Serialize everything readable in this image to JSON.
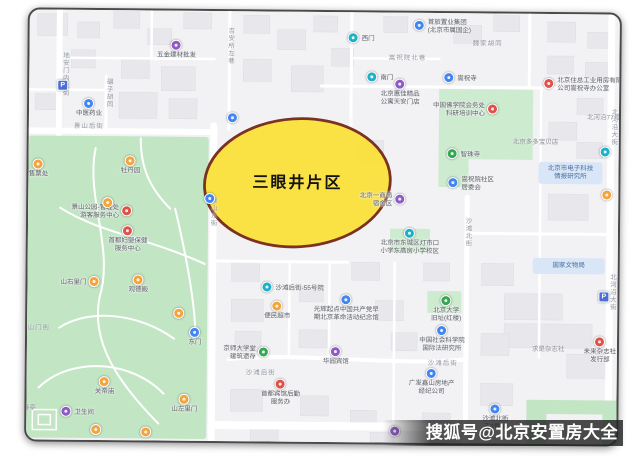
{
  "watermark": {
    "text": "搜狐号@北京安置房大全"
  },
  "highlight": {
    "label": "三眼井片区",
    "fill": "#FAE13C",
    "stroke": "#7B3222"
  },
  "map": {
    "colors": {
      "blue": "#4285F4",
      "teal": "#1FB0C9",
      "purple": "#8E5BC6",
      "orange": "#F5A33B",
      "red": "#E15149",
      "green": "#34A853",
      "parking": "#4A6FD6",
      "park_green": "#C2E5C4",
      "compound_green": "#CDEBCF",
      "road": "#FFFFFF",
      "block": "#E7E7EC"
    },
    "pins": [
      {
        "x": 175,
        "y": 47,
        "c": "purple",
        "pos": "below",
        "label": [
          "五金建材批发"
        ]
      },
      {
        "x": 62,
        "y": 88,
        "c": "parking",
        "pos": "below",
        "label": []
      },
      {
        "x": 88,
        "y": 106,
        "c": "blue",
        "pos": "below",
        "label": [
          "中医药业"
        ]
      },
      {
        "x": 22,
        "y": 133,
        "c": "blue",
        "pos": "below",
        "label": [
          "西门"
        ]
      },
      {
        "x": 38,
        "y": 167,
        "c": "orange",
        "pos": "below",
        "label": [
          "售票处"
        ]
      },
      {
        "x": 130,
        "y": 163,
        "c": "orange",
        "pos": "below",
        "label": [
          "牡丹园"
        ]
      },
      {
        "x": 108,
        "y": 205,
        "c": "orange",
        "pos": "below",
        "label": []
      },
      {
        "x": 127,
        "y": 213,
        "c": "red",
        "pos": "left",
        "label": [
          "景山公园-管理处",
          "游客服务中心"
        ]
      },
      {
        "x": 210,
        "y": 200,
        "c": "blue",
        "pos": "below",
        "label": []
      },
      {
        "x": 232,
        "y": 119,
        "c": "blue",
        "pos": "below",
        "label": []
      },
      {
        "x": 139,
        "y": 282,
        "c": "orange",
        "pos": "below",
        "label": [
          "观德殿"
        ]
      },
      {
        "x": 95,
        "y": 284,
        "c": "orange",
        "pos": "left",
        "label": [
          "山右里门"
        ]
      },
      {
        "x": 180,
        "y": 315,
        "c": "orange",
        "pos": "below",
        "label": []
      },
      {
        "x": 196,
        "y": 334,
        "c": "blue",
        "pos": "below",
        "label": [
          "东门"
        ]
      },
      {
        "x": 106,
        "y": 384,
        "c": "orange",
        "pos": "below",
        "label": [
          "关帝庙"
        ]
      },
      {
        "x": 186,
        "y": 401,
        "c": "orange",
        "pos": "below",
        "label": [
          "山左里门"
        ]
      },
      {
        "x": 68,
        "y": 414,
        "c": "purple",
        "pos": "right",
        "label": [
          "卫生间"
        ]
      },
      {
        "x": 98,
        "y": 432,
        "c": "orange",
        "pos": "below",
        "label": []
      },
      {
        "x": 148,
        "y": 434,
        "c": "orange",
        "pos": "below",
        "label": []
      },
      {
        "x": 352,
        "y": 38,
        "c": "teal",
        "pos": "right",
        "label": [
          "西门"
        ]
      },
      {
        "x": 418,
        "y": 25,
        "c": "blue",
        "pos": "right",
        "label": [
          "首旅置业集团",
          "(北京市属国企)"
        ]
      },
      {
        "x": 371,
        "y": 77,
        "c": "teal",
        "pos": "right",
        "label": [
          "南门"
        ]
      },
      {
        "x": 399,
        "y": 84,
        "c": "purple",
        "pos": "below",
        "label": [
          "北京惠佳精品",
          "公寓天安门店"
        ]
      },
      {
        "x": 448,
        "y": 77,
        "c": "blue",
        "pos": "right",
        "label": [
          "嵩祝寺"
        ]
      },
      {
        "x": 548,
        "y": 82,
        "c": "red",
        "pos": "right",
        "label": [
          "北京住总工业用房有限",
          "公司嵩祝寺办公室"
        ]
      },
      {
        "x": 492,
        "y": 108,
        "c": "red",
        "pos": "left",
        "label": [
          "中国佛学院会务处",
          "科研培训中心"
        ]
      },
      {
        "x": 452,
        "y": 153,
        "c": "green",
        "pos": "right",
        "label": [
          "智珠寺"
        ]
      },
      {
        "x": 605,
        "y": 150,
        "c": "teal",
        "pos": "below",
        "label": []
      },
      {
        "x": 607,
        "y": 193,
        "c": "orange",
        "pos": "below",
        "label": []
      },
      {
        "x": 453,
        "y": 182,
        "c": "blue",
        "pos": "right",
        "label": [
          "嵩祝院社区",
          "居委会"
        ]
      },
      {
        "x": 400,
        "y": 199,
        "c": "purple",
        "pos": "left",
        "label": [
          "北京一商局",
          "宿舍区"
        ]
      },
      {
        "x": 128,
        "y": 233,
        "c": "red",
        "pos": "below",
        "label": [
          "首都妇婴保健",
          "服务中心"
        ]
      },
      {
        "x": 268,
        "y": 288,
        "c": "teal",
        "pos": "right",
        "label": [
          "沙滩后街-55号院"
        ]
      },
      {
        "x": 278,
        "y": 307,
        "c": "orange",
        "pos": "below",
        "label": [
          "便民超市"
        ]
      },
      {
        "x": 347,
        "y": 300,
        "c": "blue",
        "pos": "below",
        "label": [
          "光辉起点中国共产党早",
          "期北京革命活动纪念馆"
        ]
      },
      {
        "x": 447,
        "y": 300,
        "c": "green",
        "pos": "below",
        "label": [
          "北京大学",
          "旧址(红楼)"
        ]
      },
      {
        "x": 443,
        "y": 330,
        "c": "blue",
        "pos": "below",
        "label": [
          "中国社会科学院",
          "国际法研究所"
        ]
      },
      {
        "x": 410,
        "y": 233,
        "c": "teal",
        "pos": "below",
        "label": [
          "北京市东城区灯市口",
          "小学东高房小学校区"
        ]
      },
      {
        "x": 265,
        "y": 353,
        "c": "green",
        "pos": "left",
        "label": [
          "京师大学堂",
          "建筑遗存"
        ]
      },
      {
        "x": 337,
        "y": 352,
        "c": "purple",
        "pos": "below",
        "label": [
          "华园宾馆"
        ]
      },
      {
        "x": 282,
        "y": 385,
        "c": "red",
        "pos": "below",
        "label": [
          "首都宾馆后勤",
          "服务办"
        ]
      },
      {
        "x": 433,
        "y": 373,
        "c": "blue",
        "pos": "below",
        "label": [
          "广发鑫山房地产",
          "经纪公司"
        ]
      },
      {
        "x": 497,
        "y": 408,
        "c": "blue",
        "pos": "below",
        "label": [
          "沙滩北街",
          "乙2号院"
        ]
      },
      {
        "x": 601,
        "y": 340,
        "c": "red",
        "pos": "below",
        "label": [
          "未来杂志社",
          "发行部"
        ]
      },
      {
        "x": 605,
        "y": 295,
        "c": "parking",
        "pos": "below",
        "label": []
      },
      {
        "x": 397,
        "y": 431,
        "c": "purple",
        "pos": "below",
        "label": []
      }
    ],
    "street_labels": [
      {
        "x": 63,
        "y": 78,
        "text": "地安门内大街",
        "vertical": true
      },
      {
        "x": 228,
        "y": 52,
        "text": "吉安所左巷",
        "vertical": true
      },
      {
        "x": 107,
        "y": 104,
        "text": "碾子胡同",
        "vertical": true
      },
      {
        "x": 88,
        "y": 126,
        "text": "景山后街",
        "vertical": false
      },
      {
        "x": 212,
        "y": 222,
        "text": "景山东街",
        "vertical": true
      },
      {
        "x": 406,
        "y": 55,
        "text": "嵩祝院北巷",
        "vertical": false
      },
      {
        "x": 486,
        "y": 40,
        "text": "魏家胡同",
        "vertical": false
      },
      {
        "x": 612,
        "y": 130,
        "text": "北河沿大街",
        "vertical": true
      },
      {
        "x": 612,
        "y": 295,
        "text": "北河沿大街",
        "vertical": true
      },
      {
        "x": 467,
        "y": 240,
        "text": "沙滩北街",
        "vertical": true
      },
      {
        "x": 262,
        "y": 371,
        "text": "沙滩后街",
        "vertical": false
      },
      {
        "x": 444,
        "y": 360,
        "text": "沙滩后街",
        "vertical": false
      },
      {
        "x": 36,
        "y": 328,
        "text": "陟山门街",
        "vertical": false
      }
    ],
    "area_labels": [
      {
        "x": 553,
        "y": 344,
        "text": "求是杂志社"
      },
      {
        "x": 606,
        "y": 112,
        "text": "北河沿77号院"
      },
      {
        "x": 532,
        "y": 137,
        "text": "北京多多宝贝店"
      },
      {
        "x": 38,
        "y": 407,
        "text": "万春亭"
      }
    ],
    "civic_boxes": [
      {
        "x": 533,
        "y": 256,
        "w": 72,
        "h": 16,
        "label": [
          "国家文物局"
        ]
      },
      {
        "x": 538,
        "y": 160,
        "w": 64,
        "h": 22,
        "label": [
          "北京市电子科技",
          "情报研究所"
        ]
      }
    ]
  }
}
